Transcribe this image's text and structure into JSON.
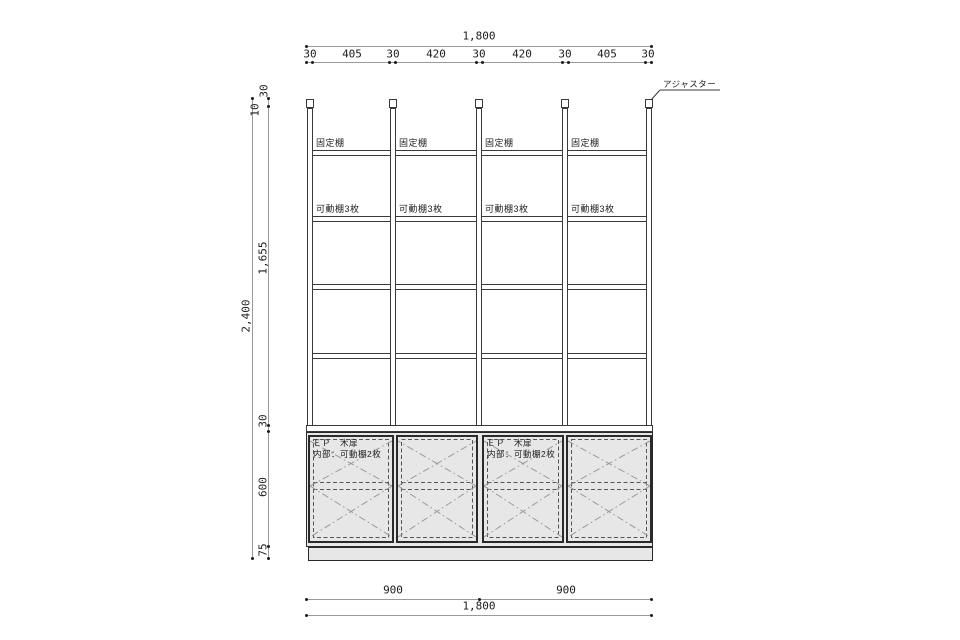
{
  "drawing": {
    "callouts": {
      "adjuster": "アジャスター"
    },
    "bay_labels": {
      "fixed_shelf": "固定棚",
      "movable_shelf": "可動棚3枚"
    },
    "door_labels": {
      "finish": "ＥＰ　木扉",
      "interior": "内部：可動棚2枚"
    },
    "dimensions": {
      "top": {
        "overall": "1,800",
        "segments": [
          "30",
          "405",
          "30",
          "420",
          "30",
          "420",
          "30",
          "405",
          "30"
        ]
      },
      "left": {
        "overall": "2,400",
        "segments": [
          "30",
          "10",
          "1,655",
          "30",
          "600",
          "75"
        ]
      },
      "bottom": {
        "halves": [
          "900",
          "900"
        ],
        "overall": "1,800"
      }
    },
    "colors": {
      "line_dark": "#3a3a3a",
      "line_dim": "#9a9a9a",
      "panel_gray": "#e7e7e7"
    }
  }
}
